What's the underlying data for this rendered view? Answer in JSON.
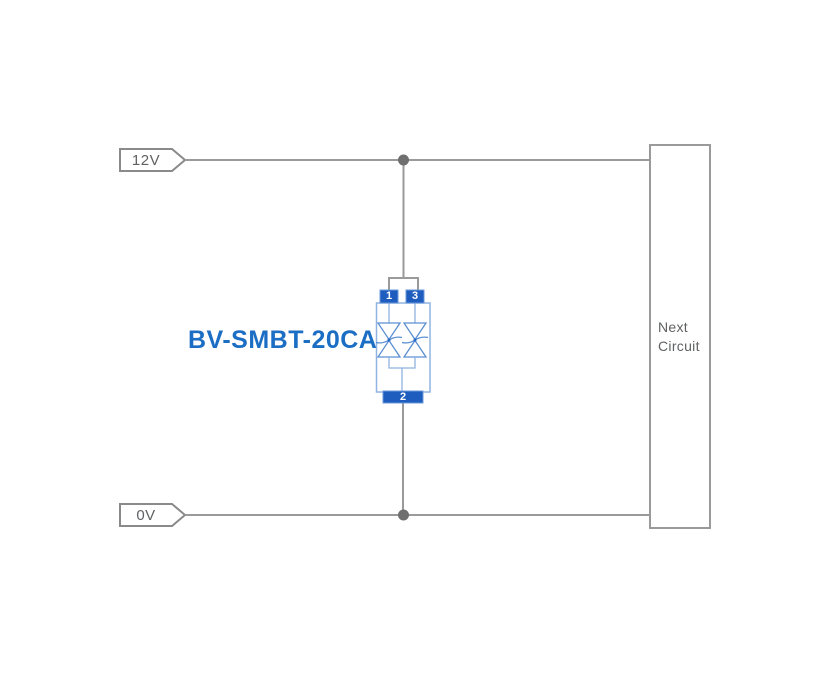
{
  "diagram": {
    "title": "TVS diode protection schematic",
    "net_labels": {
      "top": "12V",
      "bottom": "0V"
    },
    "component": {
      "label": "BV-SMBT-20CA",
      "type": "bidirectional TVS diode array",
      "pins": {
        "pin1": "1",
        "pin3": "3",
        "pin2": "2"
      }
    },
    "next_circuit": {
      "line1": "Next",
      "line2": "Circuit"
    },
    "colors": {
      "wire_gray": "#9a9a9a",
      "junction_dot": "#6f6f6f",
      "tag_border": "#8a8a8a",
      "tag_text": "#5f6163",
      "box_border": "#9a9a9a",
      "box_text": "#5f6163",
      "component_outline": "#8fb4e2",
      "diode_stroke": "#5b8fd2",
      "pin_fill": "#1e5cbe",
      "pin_border": "#6b98d9",
      "pin_text": "#ffffff",
      "label_blue": "#1b6ec4",
      "background": "#ffffff"
    }
  }
}
